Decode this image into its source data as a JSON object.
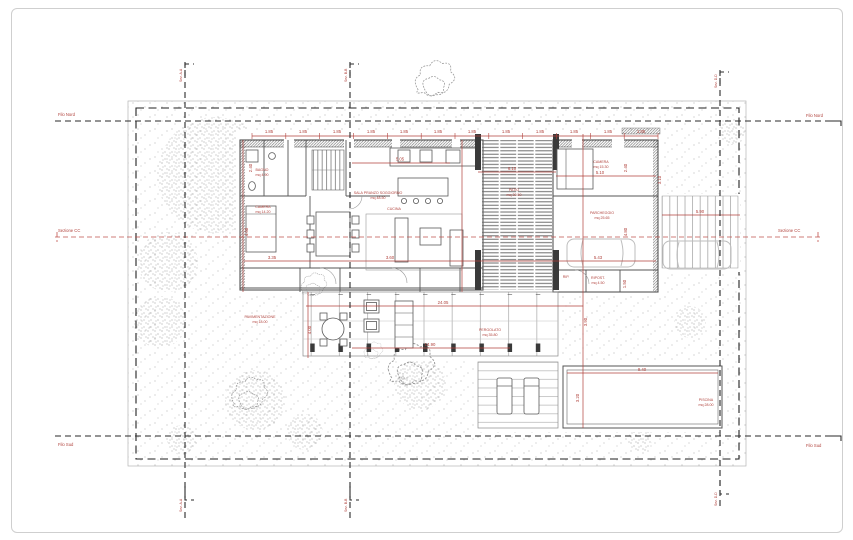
{
  "drawing": {
    "title": "Villa plan - piano terra",
    "edge_labels": {
      "north_left": "Filo Nord",
      "north_right": "Filo Nord",
      "south_left": "Filo Sud",
      "south_right": "Filo Sud",
      "section_cc_left": "Sezione CC",
      "section_cc_right": "Sezione CC",
      "section_aa_top": "Sez. A-A",
      "section_aa_bottom": "Sez. A-A",
      "section_bb_top": "Sez. B-B",
      "section_bb_bottom": "Sez. B-B",
      "section_dd_top": "Sez. D-D",
      "section_dd_bottom": "Sez. D-D"
    },
    "rooms": {
      "bagno": {
        "name": "BAGNO",
        "area": "mq 4.90"
      },
      "camera1": {
        "name": "CAMERA",
        "area": "mq 14.20"
      },
      "soggiorno": {
        "name": "SALA PRANZO SOGGIORNO",
        "area": "mq 48.50"
      },
      "cucina": {
        "name": "CUCINA",
        "area": "mq 11.80"
      },
      "patio": {
        "name": "PATIO",
        "area": "mq 30.50"
      },
      "camera2": {
        "name": "CAMERA",
        "area": "mq 15.30"
      },
      "parcheggio": {
        "name": "PARCHEGGIO",
        "area": "mq 25.65"
      },
      "ripostiglio1": {
        "name": "RIP.",
        "area": "mq 2.80"
      },
      "ripostiglio2": {
        "name": "RIPOST.",
        "area": "mq 4.50"
      },
      "pergolato": {
        "name": "PERGOLATO",
        "area": "mq 35.80"
      },
      "piscina": {
        "name": "PISCINA",
        "area": "mq 28.00"
      },
      "pavimentazione": {
        "name": "PAVIMENTAZIONE",
        "area": "mq 18.00"
      }
    },
    "dims": {
      "modules": [
        "1.85",
        "1.85",
        "1.85",
        "1.85",
        "1.85",
        "1.85",
        "1.85",
        "1.85",
        "1.85",
        "1.85",
        "1.85",
        "1.85"
      ],
      "kitchen_width": "5.05",
      "patio_width": "6.10",
      "camera2_width": "5.10",
      "left_v1": "2.40",
      "left_v2": "4.60",
      "right_v1": "2.40",
      "right_v2": "4.80",
      "right_v3": "3.10",
      "strip_v": "1.50",
      "dining_width": "3.35",
      "living_width": "3.60",
      "garage_width": "5.43",
      "driveway_width": "5.90",
      "terrace_width": "24.05",
      "terrace_inner": "14.90",
      "pool_width": "9.40",
      "pool_depth": "3.20",
      "terrace_depth": "4.00",
      "patio_depth": "3.90"
    },
    "colors": {
      "dimension_red": "#b0413b",
      "section_red": "#c0524c",
      "linework_gray": "#555555",
      "wall_dark": "#3a3a3a",
      "stipple_gray": "#9a9a9a",
      "car_gray": "#bdbdbd"
    }
  }
}
